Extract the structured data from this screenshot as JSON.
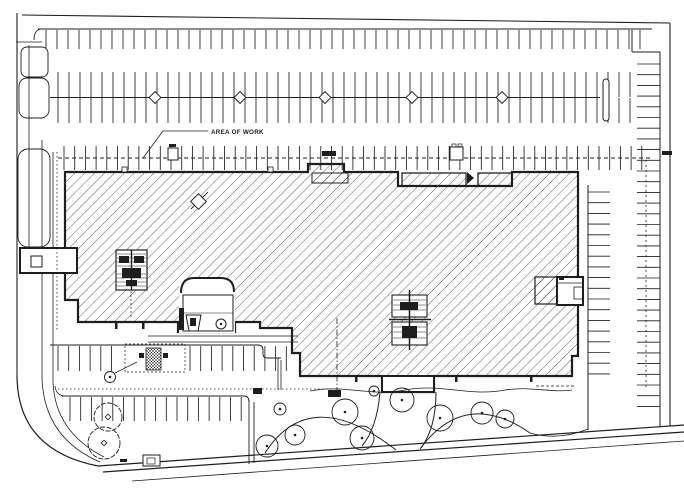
{
  "colors": {
    "paper": "#ffffff",
    "ink": "#1e1e1e",
    "hatch": "#2a2a2a"
  },
  "callout": {
    "area_of_work_label": "AREA OF WORK"
  },
  "boundary": {
    "lines": [
      [
        22,
        15,
        670,
        23,
        1.1
      ],
      [
        17,
        13,
        17,
        375,
        1.1
      ],
      [
        16,
        42,
        42,
        42,
        0.8
      ],
      [
        29,
        45,
        29,
        252,
        0.8
      ],
      [
        42,
        140,
        42,
        378,
        0.8
      ],
      [
        53,
        152,
        53,
        382,
        0.8
      ],
      [
        670,
        23,
        670,
        426,
        1.1
      ],
      [
        632,
        30,
        632,
        52,
        1.0
      ],
      [
        632,
        52,
        660,
        52,
        1.0
      ]
    ],
    "paths": [
      {
        "d": "M17,375 Q17,450 98,466",
        "w": 1.2
      },
      {
        "d": "M42,378 Q44,438 100,462",
        "w": 0.8
      },
      {
        "d": "M53,382 Q55,432 104,457",
        "w": 0.8
      },
      {
        "d": "M34,40 Q34,31 40,29",
        "w": 0.9
      }
    ],
    "islands": [
      [
        21,
        47,
        27,
        30,
        6
      ],
      [
        19,
        78,
        30,
        40,
        8
      ],
      [
        18,
        149,
        32,
        98,
        10
      ]
    ]
  },
  "street": {
    "lines": [
      [
        98,
        466,
        684,
        425,
        1.2
      ],
      [
        103,
        472,
        684,
        432,
        1.2
      ],
      [
        132,
        481,
        684,
        441,
        0.8
      ]
    ]
  },
  "parking": {
    "lines": [
      [
        38,
        29,
        652,
        29,
        1.0
      ],
      [
        50,
        97.5,
        600,
        97.5,
        0.9
      ],
      [
        50,
        345,
        258,
        345,
        1.0
      ],
      [
        62,
        396,
        244,
        396,
        1.0
      ],
      [
        249,
        402,
        249,
        464,
        0.9
      ],
      [
        254,
        402,
        254,
        463,
        0.9
      ],
      [
        660,
        52,
        660,
        426,
        1.0
      ],
      [
        588,
        185,
        588,
        430,
        1.0
      ],
      [
        148,
        336,
        298,
        336,
        0.7
      ],
      [
        148,
        342,
        298,
        342,
        0.7
      ]
    ],
    "paths": [
      {
        "d": "M258,345 Q263,345 263,350 L263,354 Q263,358 267,358 L281,358",
        "w": 0.9
      },
      {
        "d": "M278,358 L278,390",
        "w": 0.8
      },
      {
        "d": "M281,360 L281,390",
        "w": 0.8
      },
      {
        "d": "M244,396 Q249,396 249,402",
        "w": 1.0
      },
      {
        "d": "M55,386 Q56,395 64,396",
        "w": 0.8
      }
    ],
    "tick_runs": [
      {
        "o": "v",
        "x1": 46,
        "x2": 648,
        "step": 11,
        "y1": 30,
        "y2": 49,
        "w": 0.85
      },
      {
        "o": "v",
        "x1": 58,
        "x2": 634,
        "step": 11,
        "y1": 72,
        "y2": 97,
        "w": 0.85
      },
      {
        "o": "v",
        "x1": 58,
        "x2": 634,
        "step": 11,
        "y1": 98,
        "y2": 123,
        "w": 0.85
      },
      {
        "o": "v",
        "x1": 64,
        "x2": 652,
        "step": 10.7,
        "y1": 146,
        "y2": 170,
        "w": 0.85
      },
      {
        "o": "v",
        "x1": 58,
        "x2": 122,
        "step": 10.7,
        "y1": 346,
        "y2": 371,
        "w": 0.85
      },
      {
        "o": "v",
        "x1": 190,
        "x2": 288,
        "step": 10.7,
        "y1": 346,
        "y2": 371,
        "w": 0.85
      },
      {
        "o": "v",
        "x1": 70,
        "x2": 245,
        "step": 10.7,
        "y1": 397,
        "y2": 421,
        "w": 0.85
      },
      {
        "o": "v",
        "x1": 388,
        "x2": 428,
        "step": 5,
        "y1": 378,
        "y2": 390,
        "w": 0.6
      },
      {
        "o": "h",
        "y1": 64,
        "y2": 412,
        "step": 10.7,
        "x1": 637,
        "x2": 660,
        "w": 0.85
      },
      {
        "o": "h",
        "y1": 192,
        "y2": 383,
        "step": 10.7,
        "x1": 588,
        "x2": 610,
        "w": 0.85
      }
    ],
    "aisle_diamonds": {
      "y": 97.5,
      "r": 4.2,
      "xs": [
        155,
        240,
        325,
        412,
        502
      ]
    },
    "island_slot": [
      603,
      79,
      6,
      42
    ]
  },
  "work_limit": {
    "lines": [
      [
        58,
        158,
        652,
        158,
        0.9,
        "4,3"
      ],
      [
        646,
        160,
        646,
        390,
        0.8,
        "2,3"
      ],
      [
        57,
        152,
        57,
        332,
        0.8,
        "1.5,2.5"
      ],
      [
        58,
        389,
        340,
        389,
        0.8,
        "1.5,2.5"
      ],
      [
        337,
        318,
        337,
        396,
        0.8,
        "6,2,1.5,2"
      ]
    ],
    "leader": [
      {
        "d": "M208,131 L163,131 L143,158",
        "w": 0.8
      }
    ]
  },
  "landscape": {
    "paths": [
      {
        "d": "M265,453 Q310,383 396,450",
        "w": 0.9
      },
      {
        "d": "M420,449 Q465,388 530,433",
        "w": 0.9
      },
      {
        "d": "M530,433 Q558,441 588,429",
        "w": 0.9
      },
      {
        "d": "M310,391 C345,384 370,397 405,390 C440,383 470,397 505,390 C530,386 552,393 572,390",
        "w": 0.8
      },
      {
        "d": "M380,392 Q377,428 362,446",
        "w": 1.0
      },
      {
        "d": "M436,392 Q436,428 421,448",
        "w": 1.0
      },
      {
        "d": "M115,373 L137,362",
        "w": 0.7
      }
    ],
    "dashed_lines": [
      [
        536,
        386,
        574,
        386,
        0.7,
        "3,2"
      ]
    ],
    "trees": [
      {
        "x": 267,
        "y": 446,
        "r": 11
      },
      {
        "x": 295,
        "y": 435,
        "r": 10
      },
      {
        "x": 345,
        "y": 412,
        "r": 13
      },
      {
        "x": 362,
        "y": 438,
        "r": 12
      },
      {
        "x": 402,
        "y": 400,
        "r": 12
      },
      {
        "x": 440,
        "y": 418,
        "r": 13
      },
      {
        "x": 482,
        "y": 413,
        "r": 11
      },
      {
        "x": 505,
        "y": 419,
        "r": 9
      },
      {
        "x": 280,
        "y": 409,
        "r": 6
      },
      {
        "x": 374,
        "y": 391,
        "r": 5
      }
    ],
    "shrubs": [
      {
        "x": 108,
        "y": 417,
        "r": 14
      },
      {
        "x": 104,
        "y": 443,
        "r": 16
      }
    ],
    "tree_dot_r": 1.3
  },
  "marks": {
    "filled": [
      [
        322,
        151,
        14,
        5
      ],
      [
        662,
        151,
        10,
        4
      ],
      [
        253,
        388,
        9,
        6
      ],
      [
        328,
        390,
        13,
        7
      ],
      [
        120,
        459,
        7,
        3
      ],
      [
        169,
        144,
        7,
        3
      ]
    ],
    "open_boxes": [
      [
        168,
        148,
        10,
        12
      ],
      [
        450,
        147,
        13,
        13
      ],
      [
        143,
        455,
        17,
        11
      ]
    ],
    "mini": [
      [
        452,
        144,
        4,
        3
      ],
      [
        458,
        144,
        4,
        3
      ],
      [
        147,
        458,
        8,
        6
      ]
    ]
  }
}
